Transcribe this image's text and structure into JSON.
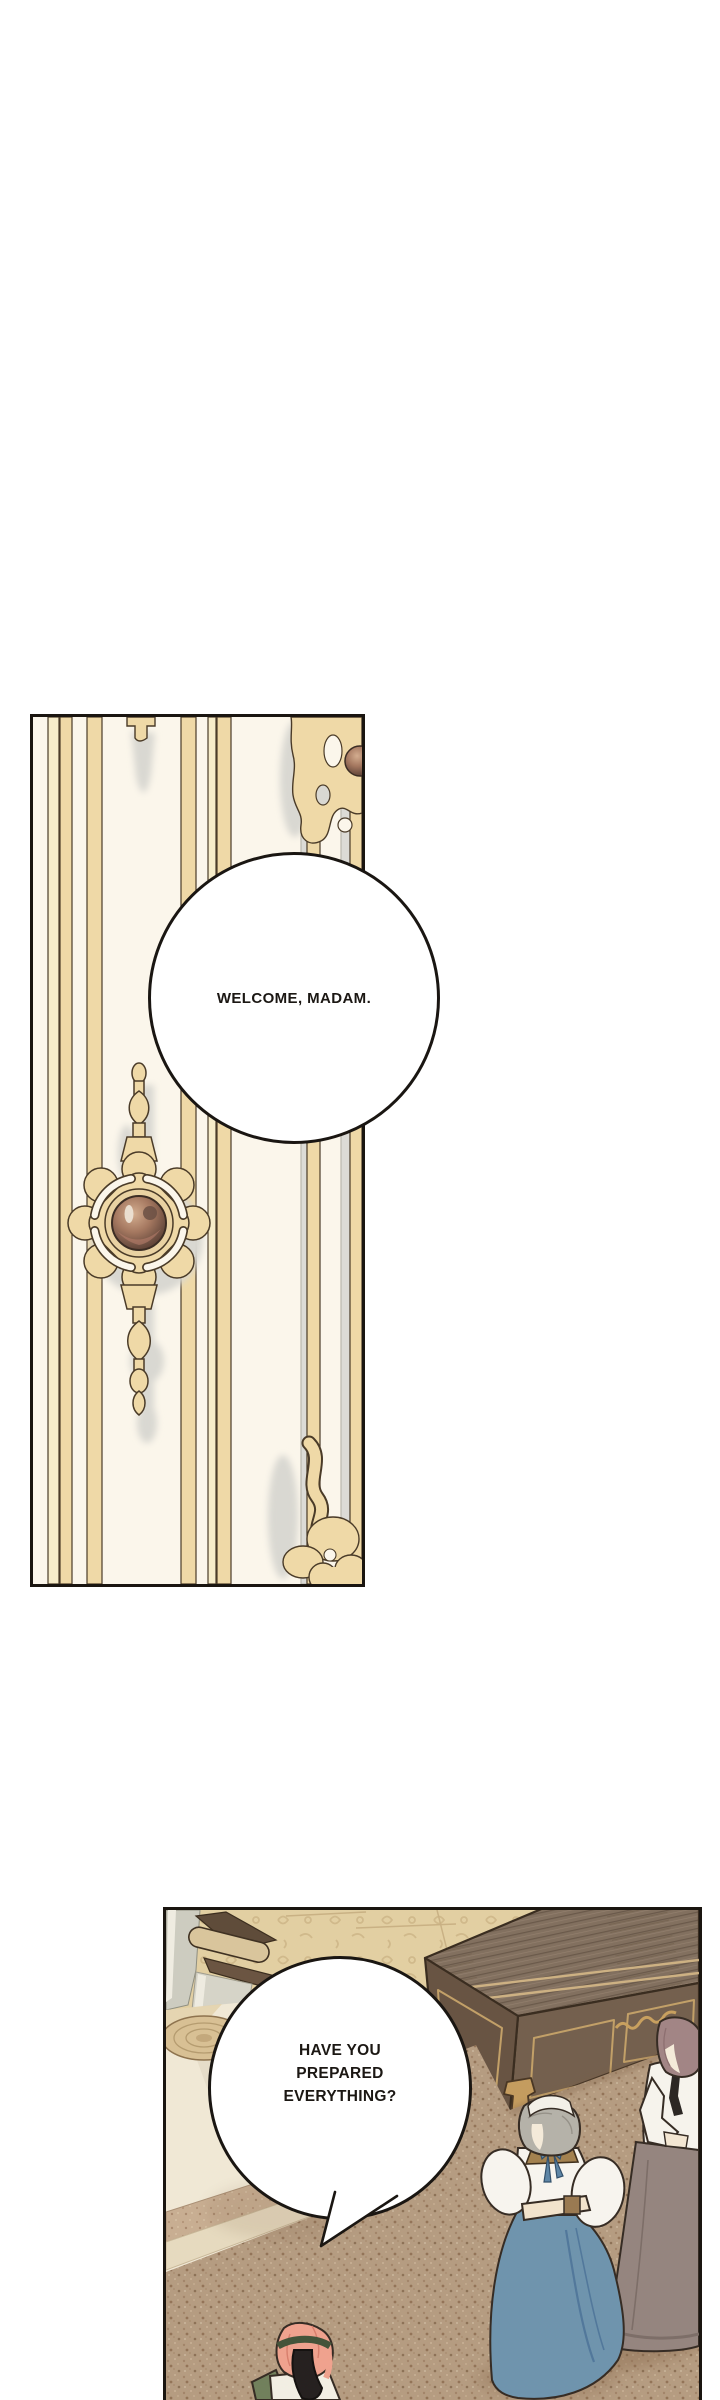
{
  "speech_bubbles": {
    "welcome": {
      "text": "WELCOME, MADAM."
    },
    "prepared": {
      "lines": [
        "HAVE YOU",
        "PREPARED",
        "EVERYTHING?"
      ]
    }
  },
  "colors": {
    "page_background": "#ffffff",
    "panel_border": "#1a1510",
    "door_background": "#fbf6eb",
    "door_gold": "#efd9a7",
    "door_gold_light": "#f6ecc9",
    "door_shadow_gray": "#d9d8d2",
    "knob_bronze_light": "#d3ad8f",
    "knob_bronze_dark": "#54392e",
    "damask_floor": "#e2cfa2",
    "chest_wood_top": "#82705f",
    "chest_wood_front": "#74604e",
    "chest_trim_gold": "#c2a068",
    "carpet_tan": "#b59c81",
    "cream_floor": "#f0e8d5",
    "wall_gray_green": "#cdccc0",
    "maid_skirt_blue": "#6f94ad",
    "maid_hair_gray": "#b5b2a9",
    "maid_collar_brown": "#a3814f",
    "lady_hair_mauve": "#a28585",
    "lady_skirt_taupe": "#95857f",
    "attendant_hair_pink": "#efa28e",
    "speech_text": "#1b1713"
  }
}
